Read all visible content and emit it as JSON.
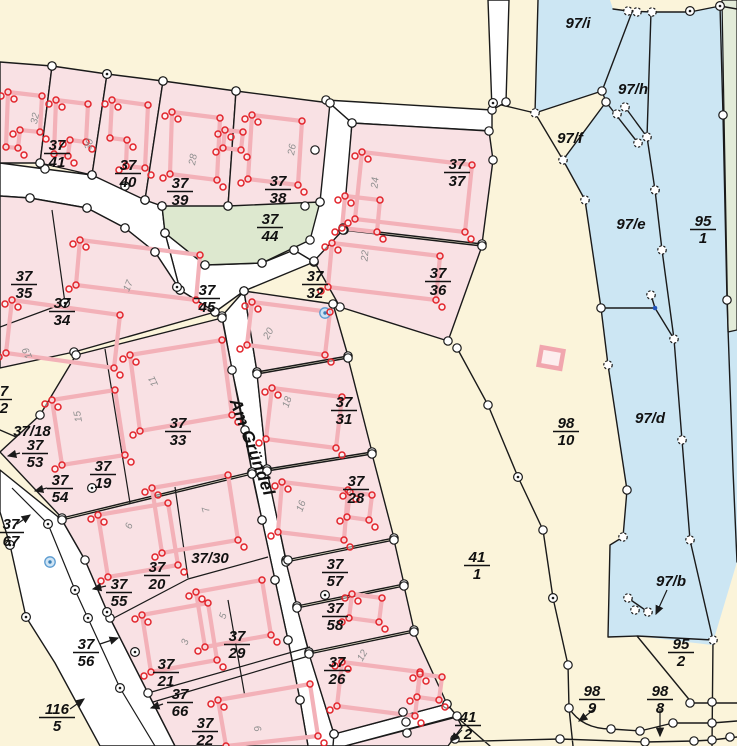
{
  "map": {
    "street": {
      "name": "Am Gründel"
    },
    "colors": {
      "background": "#fbf4da",
      "water": "#cce6f3",
      "parcel": "#f9e1e4",
      "building": "#f3b1b8",
      "point": "#e2242b",
      "green": "#dde8cf",
      "green_edge": "#e3ecd9",
      "street": "#ffffff",
      "line": "#1a1a1a",
      "label": "#111111",
      "house_number": "#8f8f8f",
      "marker_blue": "#5b9bd0"
    },
    "parcel_labels": [
      {
        "t": "37",
        "b": "41",
        "x": 57,
        "y": 150
      },
      {
        "t": "37",
        "b": "40",
        "x": 128,
        "y": 170
      },
      {
        "t": "37",
        "b": "39",
        "x": 180,
        "y": 188
      },
      {
        "t": "37",
        "b": "38",
        "x": 278,
        "y": 186
      },
      {
        "t": "37",
        "b": "37",
        "x": 457,
        "y": 169
      },
      {
        "t": "37",
        "b": "44",
        "x": 270,
        "y": 224
      },
      {
        "t": "37",
        "b": "36",
        "x": 438,
        "y": 278
      },
      {
        "t": "37",
        "b": "45",
        "x": 207,
        "y": 295
      },
      {
        "t": "37",
        "b": "32",
        "x": 315,
        "y": 281
      },
      {
        "t": "37",
        "b": "35",
        "x": 24,
        "y": 281
      },
      {
        "t": "37",
        "b": "34",
        "x": 62,
        "y": 308
      },
      {
        "t": "37",
        "b": "31",
        "x": 344,
        "y": 407
      },
      {
        "t": "37",
        "b": "33",
        "x": 178,
        "y": 428
      },
      {
        "t": "7",
        "b": "2",
        "x": 4,
        "y": 396
      },
      {
        "t": "37/18",
        "x": 32,
        "y": 430
      },
      {
        "t": "37",
        "b": "53",
        "x": 35,
        "y": 450
      },
      {
        "t": "37",
        "b": "19",
        "x": 103,
        "y": 471
      },
      {
        "t": "37",
        "b": "54",
        "x": 60,
        "y": 485
      },
      {
        "t": "37",
        "b": "67",
        "x": 11,
        "y": 529
      },
      {
        "t": "37/30",
        "x": 210,
        "y": 557
      },
      {
        "t": "37",
        "b": "20",
        "x": 157,
        "y": 572
      },
      {
        "t": "37",
        "b": "55",
        "x": 119,
        "y": 589
      },
      {
        "t": "37",
        "b": "29",
        "x": 237,
        "y": 641
      },
      {
        "t": "37",
        "b": "56",
        "x": 86,
        "y": 649
      },
      {
        "t": "37",
        "b": "21",
        "x": 166,
        "y": 669
      },
      {
        "t": "37",
        "b": "66",
        "x": 180,
        "y": 699
      },
      {
        "t": "116",
        "b": "5",
        "x": 57,
        "y": 714
      },
      {
        "t": "37",
        "b": "22",
        "x": 205,
        "y": 728
      },
      {
        "t": "37",
        "b": "28",
        "x": 356,
        "y": 486
      },
      {
        "t": "37",
        "b": "57",
        "x": 335,
        "y": 569
      },
      {
        "t": "37",
        "b": "58",
        "x": 335,
        "y": 613
      },
      {
        "t": "37",
        "b": "26",
        "x": 337,
        "y": 667
      },
      {
        "t": "41",
        "b": "1",
        "x": 477,
        "y": 562
      },
      {
        "t": "41",
        "b": "2",
        "x": 468,
        "y": 722
      },
      {
        "t": "98",
        "b": "10",
        "x": 566,
        "y": 428
      },
      {
        "t": "98",
        "b": "9",
        "x": 592,
        "y": 696
      },
      {
        "t": "98",
        "b": "8",
        "x": 660,
        "y": 696
      },
      {
        "t": "95",
        "b": "1",
        "x": 703,
        "y": 226
      },
      {
        "t": "95",
        "b": "2",
        "x": 681,
        "y": 649
      },
      {
        "t": "97/i",
        "x": 578,
        "y": 22
      },
      {
        "t": "97/h",
        "x": 633,
        "y": 88
      },
      {
        "t": "97/f",
        "x": 570,
        "y": 137
      },
      {
        "t": "97/e",
        "x": 631,
        "y": 223
      },
      {
        "t": "97/d",
        "x": 650,
        "y": 417
      },
      {
        "t": "97/b",
        "x": 671,
        "y": 580
      }
    ],
    "house_numbers": [
      {
        "text": "32",
        "x": 38,
        "y": 119,
        "rot": -78
      },
      {
        "text": "30",
        "x": 92,
        "y": 145,
        "rot": -78
      },
      {
        "text": "28",
        "x": 196,
        "y": 160,
        "rot": -80
      },
      {
        "text": "26",
        "x": 295,
        "y": 150,
        "rot": -80
      },
      {
        "text": "24",
        "x": 378,
        "y": 183,
        "rot": -85
      },
      {
        "text": "22",
        "x": 368,
        "y": 256,
        "rot": -85
      },
      {
        "text": "20",
        "x": 271,
        "y": 335,
        "rot": -60
      },
      {
        "text": "17",
        "x": 131,
        "y": 287,
        "rot": -68
      },
      {
        "text": "19",
        "x": 30,
        "y": 352,
        "rot": -115
      },
      {
        "text": "11",
        "x": 156,
        "y": 380,
        "rot": -115
      },
      {
        "text": "15",
        "x": 81,
        "y": 416,
        "rot": -100
      },
      {
        "text": "18",
        "x": 290,
        "y": 403,
        "rot": -72
      },
      {
        "text": "16",
        "x": 304,
        "y": 507,
        "rot": -70
      },
      {
        "text": "7",
        "x": 209,
        "y": 509,
        "rot": -105
      },
      {
        "text": "6",
        "x": 132,
        "y": 527,
        "rot": -70
      },
      {
        "text": "5",
        "x": 226,
        "y": 617,
        "rot": -70
      },
      {
        "text": "3",
        "x": 188,
        "y": 643,
        "rot": -72
      },
      {
        "text": "12",
        "x": 365,
        "y": 657,
        "rot": -60
      },
      {
        "text": "9",
        "x": 261,
        "y": 728,
        "rot": -105
      }
    ]
  }
}
